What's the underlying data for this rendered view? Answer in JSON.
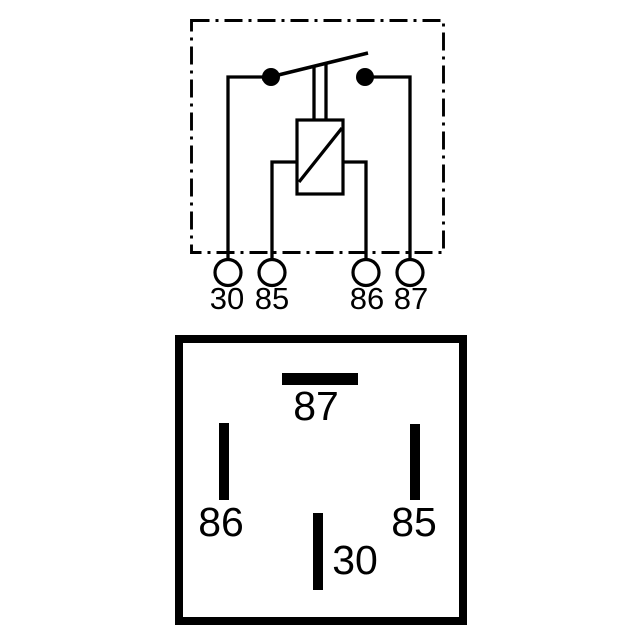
{
  "colors": {
    "ink": "#000000",
    "background": "#ffffff"
  },
  "schematic": {
    "terminal_labels": [
      "30",
      "85",
      "86",
      "87"
    ]
  },
  "pinout": {
    "pin_labels": [
      "87",
      "86",
      "85",
      "30"
    ]
  }
}
